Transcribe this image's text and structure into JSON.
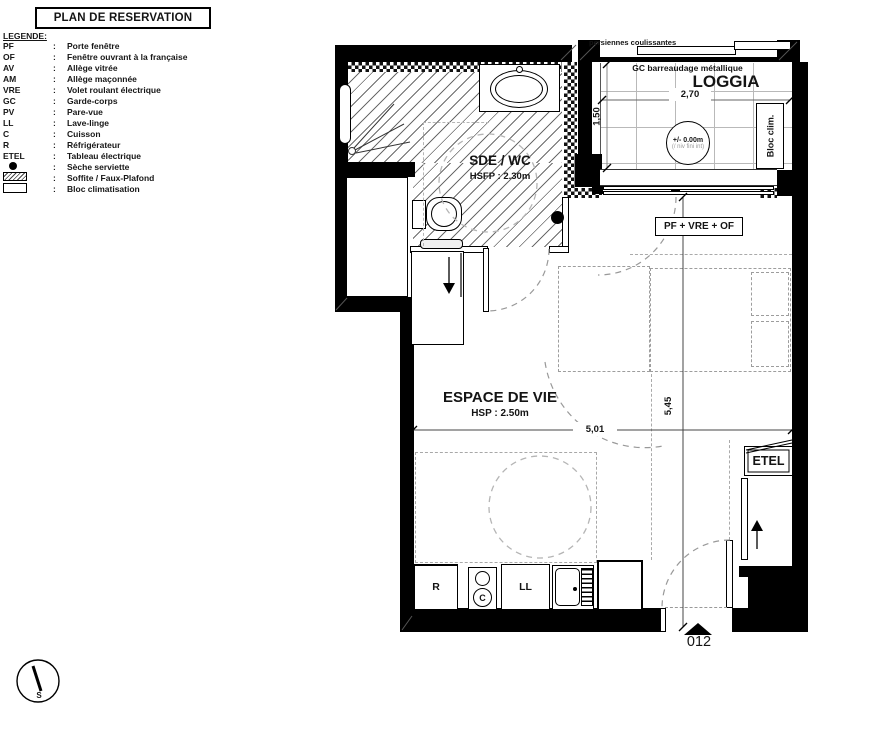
{
  "title": "PLAN DE RESERVATION",
  "colors": {
    "ink": "#161616",
    "dash_gray": "#9d9d9d"
  },
  "legend": {
    "heading": "LEGENDE:",
    "separator": ":",
    "items": [
      {
        "abbr": "PF",
        "desc": "Porte fenêtre"
      },
      {
        "abbr": "OF",
        "desc": "Fenêtre ouvrant à la française"
      },
      {
        "abbr": "AV",
        "desc": "Allège vitrée"
      },
      {
        "abbr": "AM",
        "desc": "Allège maçonnée"
      },
      {
        "abbr": "VRE",
        "desc": "Volet roulant électrique"
      },
      {
        "abbr": "GC",
        "desc": "Garde-corps"
      },
      {
        "abbr": "PV",
        "desc": "Pare-vue"
      },
      {
        "abbr": "LL",
        "desc": "Lave-linge"
      },
      {
        "abbr": "C",
        "desc": "Cuisson"
      },
      {
        "abbr": "R",
        "desc": "Réfrigérateur"
      },
      {
        "abbr": "ETEL",
        "desc": "Tableau électrique"
      },
      {
        "abbr": "",
        "symbol": "dot",
        "desc": "Sèche serviette"
      },
      {
        "abbr": "",
        "symbol": "hatch",
        "desc": "Soffite / Faux-Plafond"
      },
      {
        "abbr": "",
        "symbol": "box",
        "desc": "Bloc climatisation"
      }
    ]
  },
  "plan": {
    "sdewc": {
      "name": "SDE / WC",
      "ceiling": "HSFP : 2.30m"
    },
    "loggia": {
      "name": "LOGGIA",
      "gc": "GC barreaudage métallique",
      "persiennes": "persiennes coulissantes",
      "level": "+/- 0.00m",
      "level_note": "(/ niv fini int)",
      "bloc_clim": "Bloc clim.",
      "width": "2,70",
      "depth": "1,50"
    },
    "living": {
      "name": "ESPACE DE VIE",
      "ceiling": "HSP : 2.50m",
      "width": "5,01",
      "depth": "5,45"
    },
    "window_label": "PF + VRE + OF",
    "etel": "ETEL",
    "unit": "012",
    "appliances": {
      "fridge": "R",
      "cook": "C",
      "washer": "LL"
    },
    "compass_south": "S"
  }
}
